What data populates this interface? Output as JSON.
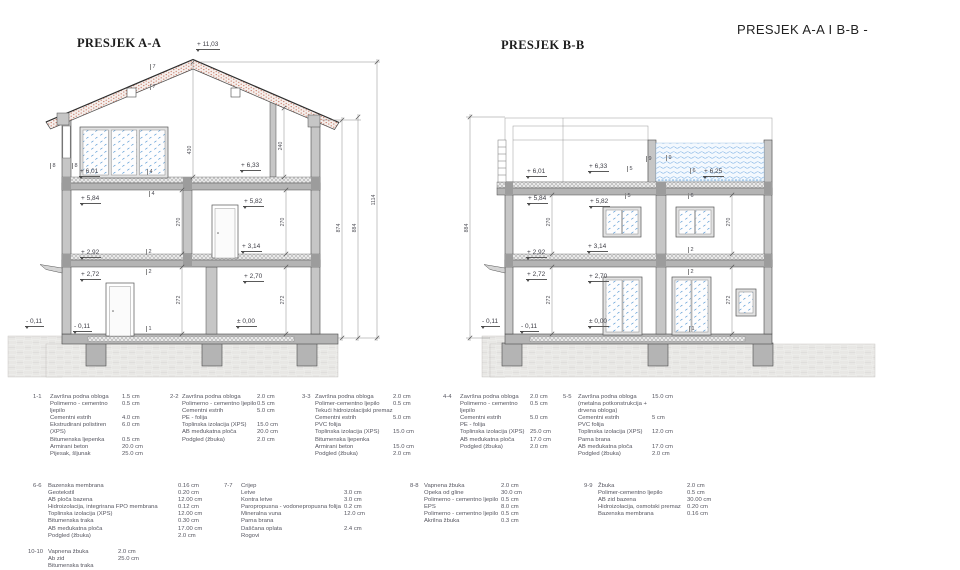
{
  "titles": {
    "main": "PRESJEK A-A I B-B -",
    "aa": "PRESJEK A-A",
    "bb": "PRESJEK B-B"
  },
  "colors": {
    "wall": "#c6c6c6",
    "slab": "#b4b4b4",
    "beam": "#9c9c9c",
    "line": "#4a4a4a",
    "roof_dot": "#c0604a",
    "glass_fleck": "#5b9bd5",
    "water_line": "#7fb2e5",
    "ground_line": "#c9c7c4",
    "text": "#3e3e46"
  },
  "labels": {
    "elevations": [
      [
        "+ 11,03",
        196,
        41
      ],
      [
        "+ 6,01",
        79,
        168
      ],
      [
        "+ 6,33",
        240,
        162
      ],
      [
        "+ 5,84",
        80,
        195
      ],
      [
        "+ 5,82",
        243,
        198
      ],
      [
        "+ 3,14",
        241,
        243
      ],
      [
        "+ 2,92",
        80,
        249
      ],
      [
        "+ 2,72",
        80,
        271
      ],
      [
        "+ 2,70",
        243,
        273
      ],
      [
        "- 0,11",
        25,
        318
      ],
      [
        "- 0,11",
        73,
        323
      ],
      [
        "± 0,00",
        236,
        318
      ],
      [
        "+ 6,01",
        526,
        168
      ],
      [
        "+ 6,33",
        588,
        163
      ],
      [
        "+ 6,25",
        703,
        168
      ],
      [
        "+ 5,84",
        527,
        195
      ],
      [
        "+ 5,82",
        589,
        198
      ],
      [
        "+ 3,14",
        587,
        243
      ],
      [
        "+ 2,92",
        526,
        249
      ],
      [
        "+ 2,72",
        526,
        271
      ],
      [
        "+ 2,70",
        588,
        273
      ],
      [
        "- 0,11",
        481,
        318
      ],
      [
        "- 0,11",
        520,
        323
      ],
      [
        "± 0,00",
        588,
        318
      ]
    ],
    "dimensions": [
      [
        "430",
        190,
        150
      ],
      [
        "240",
        281,
        146
      ],
      [
        "270",
        179,
        222
      ],
      [
        "270",
        283,
        222
      ],
      [
        "272",
        179,
        300
      ],
      [
        "272",
        283,
        300
      ],
      [
        "874",
        339,
        228
      ],
      [
        "884",
        355,
        228
      ],
      [
        "1114",
        374,
        200
      ],
      [
        "884",
        467,
        228
      ],
      [
        "270",
        549,
        222
      ],
      [
        "270",
        729,
        222
      ],
      [
        "272",
        549,
        300
      ],
      [
        "272",
        729,
        300
      ]
    ],
    "refs": [
      [
        "7",
        150,
        64
      ],
      [
        "7",
        150,
        84
      ],
      [
        "8",
        50,
        163
      ],
      [
        "8",
        72,
        163
      ],
      [
        "4",
        147,
        169
      ],
      [
        "4",
        149,
        191
      ],
      [
        "2",
        146,
        249
      ],
      [
        "2",
        146,
        269
      ],
      [
        "1",
        146,
        326
      ],
      [
        "5",
        627,
        166
      ],
      [
        "5",
        625,
        193
      ],
      [
        "6",
        690,
        168
      ],
      [
        "6",
        688,
        193
      ],
      [
        "9",
        646,
        156
      ],
      [
        "9",
        666,
        155
      ],
      [
        "2",
        688,
        247
      ],
      [
        "2",
        688,
        269
      ],
      [
        "1",
        689,
        326
      ]
    ]
  },
  "legend": {
    "notes": [
      {
        "id": "1-1",
        "x": 33,
        "y": 394,
        "idw": 17,
        "nw": 72,
        "layers": [
          [
            "Završna podna obloga",
            "1.5 cm"
          ],
          [
            "Polimerno - cementno ljepilo",
            "0.5 cm"
          ],
          [
            "Cementni estrih",
            "4.0 cm"
          ],
          [
            "Ekstrudirani polistiren (XPS)",
            "6.0 cm"
          ],
          [
            "Bitumenska ljepenka",
            "0.5 cm"
          ],
          [
            "Armirani beton",
            "20.0 cm"
          ],
          [
            "Pijesak, šljunak",
            "25.0 cm"
          ]
        ]
      },
      {
        "id": "2-2",
        "x": 170,
        "y": 394,
        "idw": 12,
        "nw": 75,
        "layers": [
          [
            "Završna podna obloga",
            "2.0 cm"
          ],
          [
            "Polimerno - cementno ljepilo",
            "0.5 cm"
          ],
          [
            "Cementni estrih",
            "5.0 cm"
          ],
          [
            "PE - folija",
            ""
          ],
          [
            "Toplinska izolacija (XPS)",
            "15.0 cm"
          ],
          [
            "AB međukatna ploča",
            "20.0 cm"
          ],
          [
            "Podgled (žbuka)",
            "2.0 cm"
          ]
        ]
      },
      {
        "id": "3-3",
        "x": 302,
        "y": 394,
        "idw": 13,
        "nw": 78,
        "layers": [
          [
            "Završna podna obloga",
            "2.0 cm"
          ],
          [
            "Polimer-cementno ljepilo",
            "0.5 cm"
          ],
          [
            "Tekući hidroizolacijski premaz",
            ""
          ],
          [
            "Cementni estrih",
            "5.0 cm"
          ],
          [
            "PVC folija",
            ""
          ],
          [
            "Toplinska izolacija (XPS)",
            "15.0 cm"
          ],
          [
            "Bitumenska ljepenka",
            ""
          ],
          [
            "Armirani beton",
            "15.0 cm"
          ],
          [
            "Podgled (žbuka)",
            "2.0 cm"
          ]
        ]
      },
      {
        "id": "4-4",
        "x": 443,
        "y": 394,
        "idw": 17,
        "nw": 70,
        "layers": [
          [
            "Završna podna obloga",
            "2.0 cm"
          ],
          [
            "Polimerno - cementno ljepilo",
            "0.5 cm"
          ],
          [
            "Cementni estrih",
            "5.0 cm"
          ],
          [
            "PE - folija",
            ""
          ],
          [
            "Toplinska izolacija (XPS)",
            "25.0 cm"
          ],
          [
            "AB međukatna ploča",
            "17.0 cm"
          ],
          [
            "Podgled (žbuka)",
            "2.0 cm"
          ]
        ]
      },
      {
        "id": "5-5",
        "x": 563,
        "y": 394,
        "idw": 15,
        "nw": 74,
        "layers": [
          [
            "Završna podna obloga",
            "15.0 cm"
          ],
          [
            "(metalna potkonstrukcija + drvena obloga)",
            ""
          ],
          [
            "Cementni estrih",
            "5 cm"
          ],
          [
            "PVC folija",
            ""
          ],
          [
            "Toplinska izolacija (XPS)",
            "12.0 cm"
          ],
          [
            "Parna brana",
            ""
          ],
          [
            "AB međukatna ploča",
            "17.0 cm"
          ],
          [
            "Podgled (žbuka)",
            "2.0 cm"
          ]
        ]
      },
      {
        "id": "6-6",
        "x": 33,
        "y": 483,
        "idw": 15,
        "nw": 130,
        "layers": [
          [
            "Bazenska membrana",
            "0.16 cm"
          ],
          [
            "Geotekstil",
            "0.20 cm"
          ],
          [
            "AB ploča bazena",
            "12.00 cm"
          ],
          [
            "Hidroizolacija, integrirana FPO membrana",
            "0.12 cm"
          ],
          [
            "Toplinska izolacija  (XPS)",
            "12.00 cm"
          ],
          [
            "Bitumenska traka",
            "0.30 cm"
          ],
          [
            "AB međukatna ploča",
            "17.00 cm"
          ],
          [
            "Podgled (žbuka)",
            "2.0 cm"
          ]
        ]
      },
      {
        "id": "7-7",
        "x": 224,
        "y": 483,
        "idw": 17,
        "nw": 103,
        "layers": [
          [
            "Crijep",
            ""
          ],
          [
            "Letve",
            "3.0 cm"
          ],
          [
            "Kontra letve",
            "3.0 cm"
          ],
          [
            "Paropropusna - vodonepropusna folija",
            "0.2 cm"
          ],
          [
            "Mineralna vuna",
            "12.0 cm"
          ],
          [
            "Parna brana",
            ""
          ],
          [
            "Daščana oplata",
            "2.4 cm"
          ],
          [
            "Rogovi",
            ""
          ]
        ]
      },
      {
        "id": "8-8",
        "x": 410,
        "y": 483,
        "idw": 14,
        "nw": 77,
        "layers": [
          [
            "Vapnena žbuka",
            "2.0 cm"
          ],
          [
            "Opeka od gline",
            "30.0 cm"
          ],
          [
            "Polimerno - cementno ljepilo",
            "0.5 cm"
          ],
          [
            "EPS",
            "8.0 cm"
          ],
          [
            "Polimerno - cementno ljepilo",
            "0.5 cm"
          ],
          [
            "Akrilna žbuka",
            "0.3 cm"
          ]
        ]
      },
      {
        "id": "9-9",
        "x": 584,
        "y": 483,
        "idw": 14,
        "nw": 89,
        "layers": [
          [
            "Žbuka",
            "2.0 cm"
          ],
          [
            "Polimer-cementno ljepilo",
            "0.5 cm"
          ],
          [
            "AB zid bazena",
            "30.00 cm"
          ],
          [
            "Hidroizolacija, osmotski premaz",
            "0.20 cm"
          ],
          [
            "Bazenska membrana",
            "0.16 cm"
          ]
        ]
      },
      {
        "id": "10-10",
        "x": 28,
        "y": 549,
        "idw": 20,
        "nw": 70,
        "layers": [
          [
            "Vapnena žbuka",
            "2.0 cm"
          ],
          [
            "Ab zid",
            "25.0 cm"
          ],
          [
            "Bitumenska traka",
            ""
          ]
        ]
      }
    ]
  }
}
